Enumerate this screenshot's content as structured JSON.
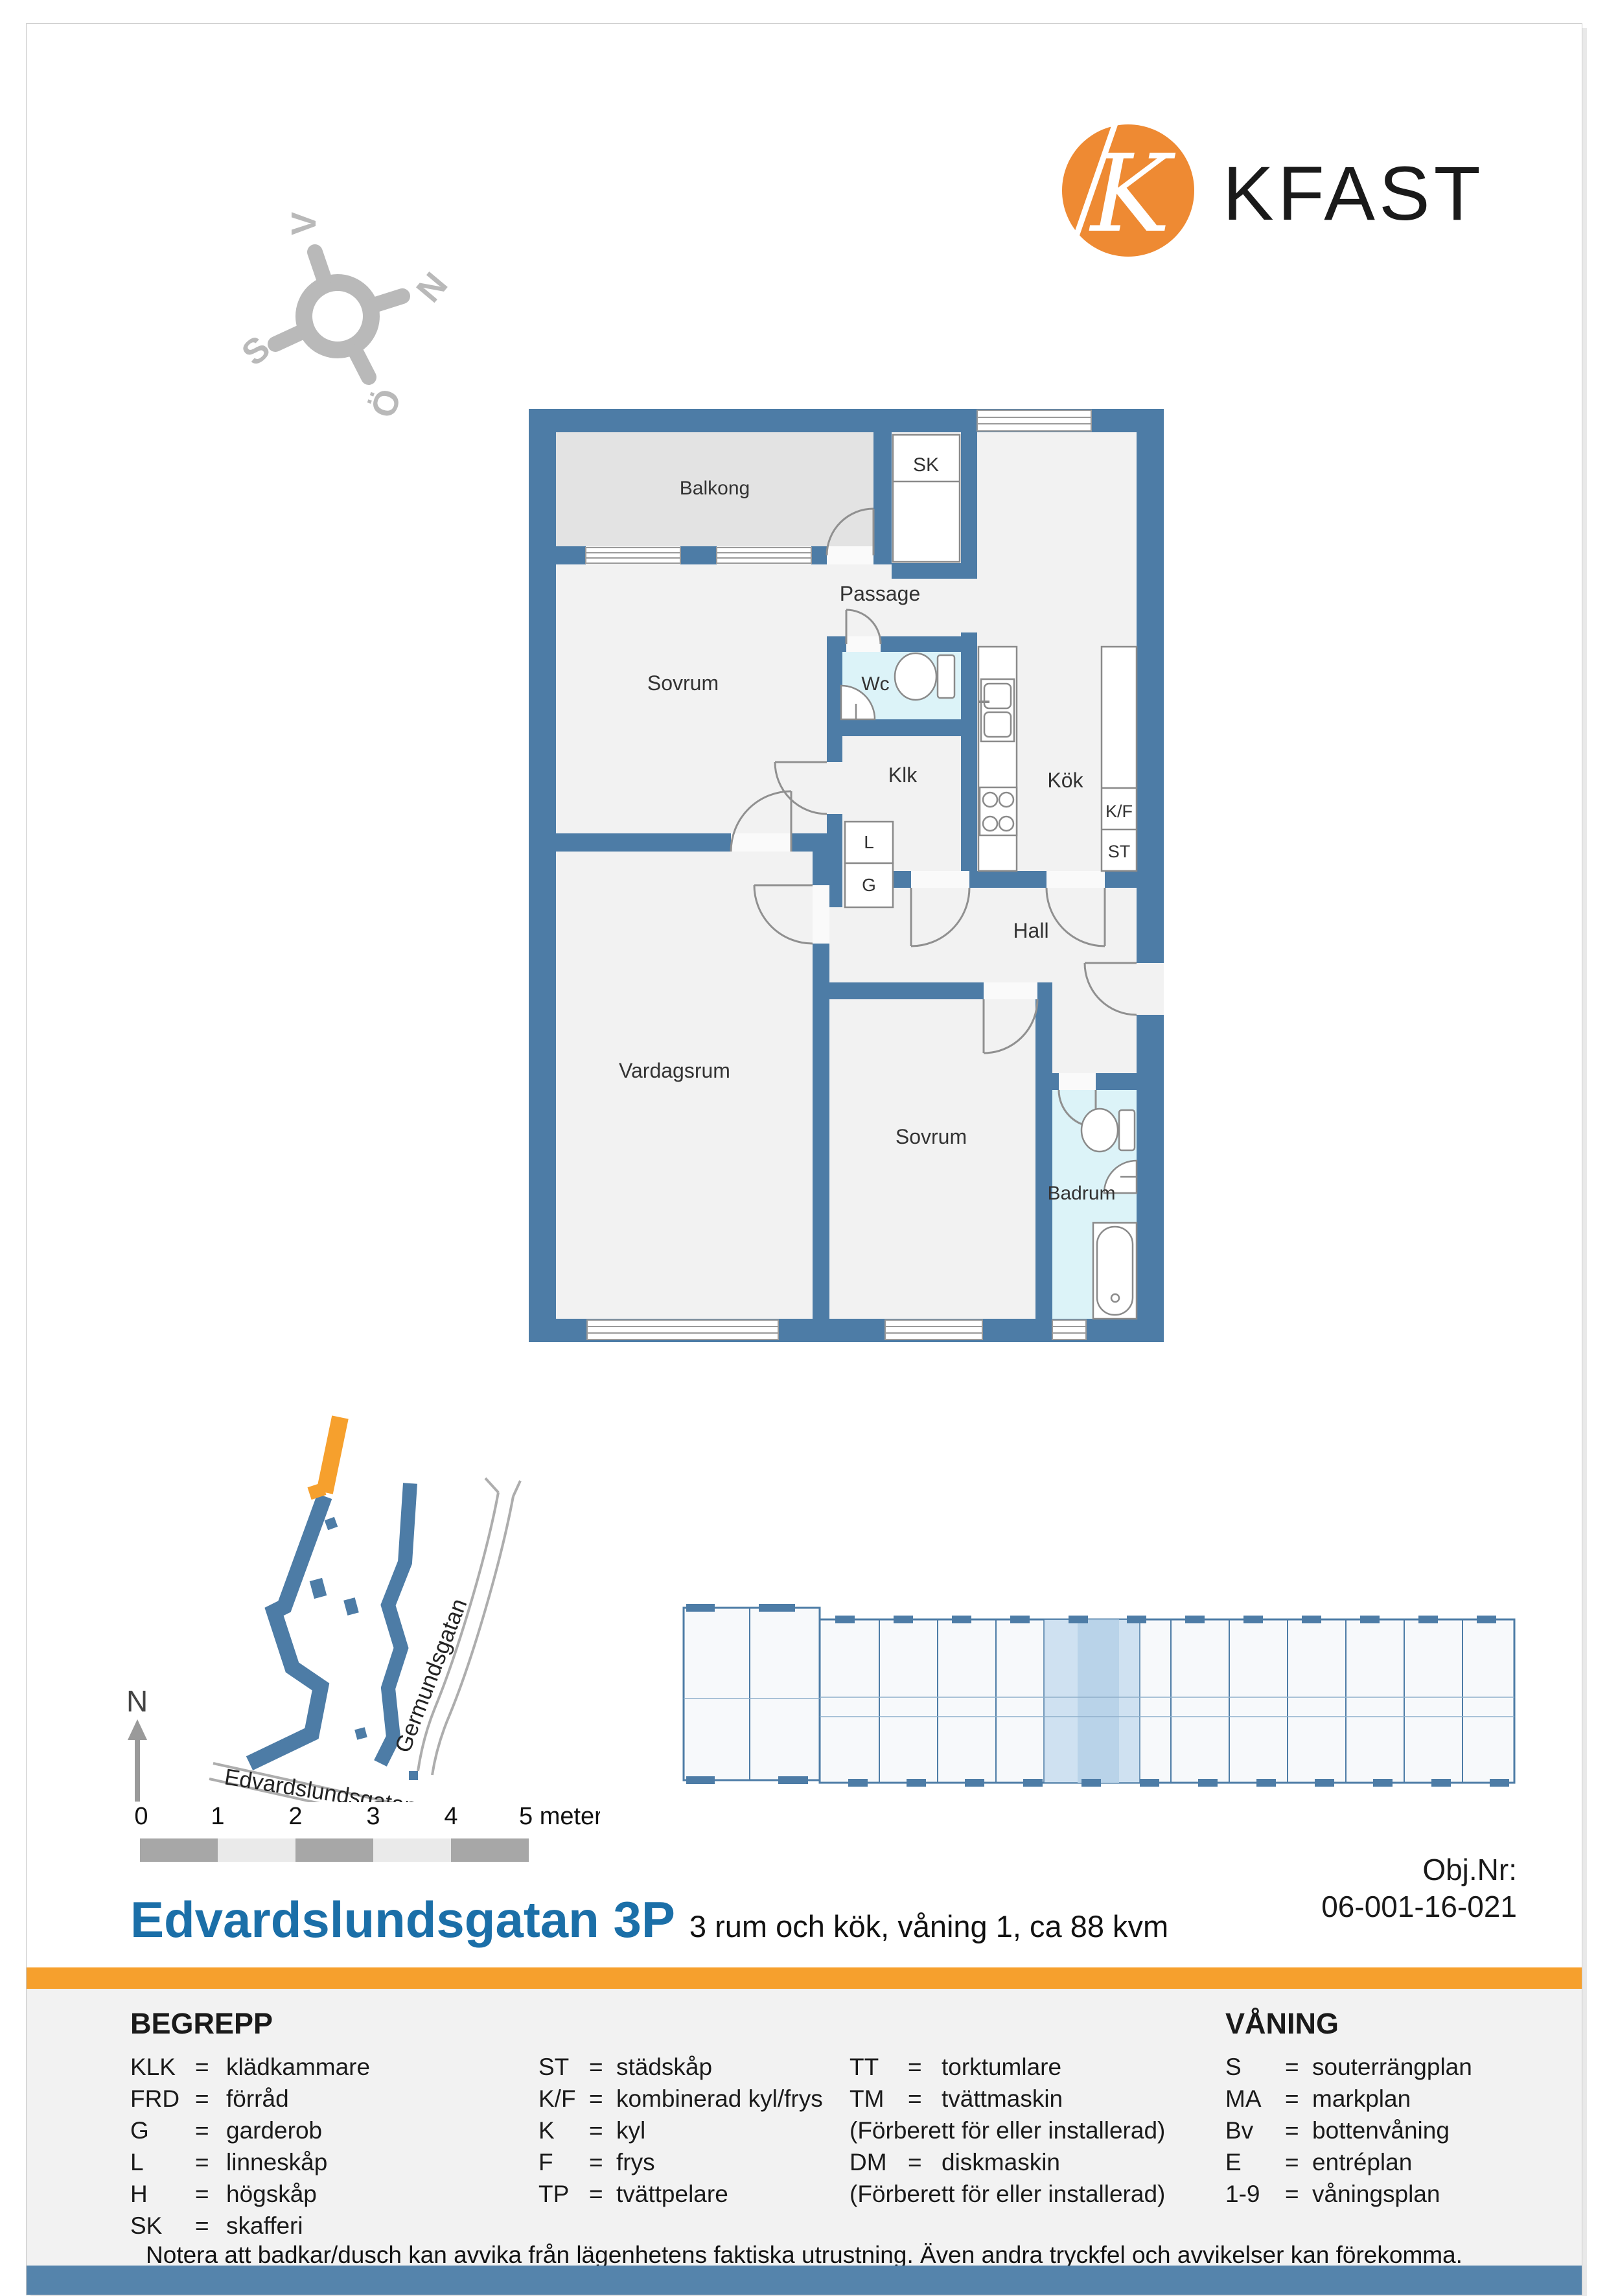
{
  "logo": {
    "k": "K",
    "name": "KFAST",
    "circle_color": "#EE8A33"
  },
  "compass": {
    "n": "N",
    "s": "S",
    "o": "Ö",
    "v": "V"
  },
  "floorplan": {
    "colors": {
      "wall": "#4D7CA6",
      "floor": "#F2F2F2",
      "balcony": "#E3E3E3",
      "wet": "#DCF3F8"
    },
    "rooms": {
      "balkong": "Balkong",
      "passage": "Passage",
      "sk": "SK",
      "sovrum1": "Sovrum",
      "wc": "Wc",
      "klk": "Klk",
      "kok": "Kök",
      "kf": "K/F",
      "st": "ST",
      "l": "L",
      "g": "G",
      "hall": "Hall",
      "vardagsrum": "Vardagsrum",
      "sovrum2": "Sovrum",
      "badrum": "Badrum"
    }
  },
  "sitemap": {
    "street1": "Germundsgatan",
    "street2": "Edvardslundsgatan",
    "north": "N",
    "highlight_color": "#F6A02D",
    "building_color": "#4D7CA6"
  },
  "overview": {
    "highlight_color": "#C9DCEE"
  },
  "scalebar": {
    "ticks": [
      "0",
      "1",
      "2",
      "3",
      "4"
    ],
    "last": "5 meter"
  },
  "title_block": {
    "title": "Edvardslundsgatan 3P",
    "subtitle": "3 rum och kök, våning 1, ca 88 kvm",
    "obj_label": "Obj.Nr:",
    "obj_number": "06-001-16-021"
  },
  "legend": {
    "heading": "BEGREPP",
    "eq": "=",
    "col1": [
      {
        "abbr": "KLK",
        "label": "klädkammare"
      },
      {
        "abbr": "FRD",
        "label": "förråd"
      },
      {
        "abbr": "G",
        "label": "garderob"
      },
      {
        "abbr": "L",
        "label": "linneskåp"
      },
      {
        "abbr": "H",
        "label": "högskåp"
      },
      {
        "abbr": "SK",
        "label": "skafferi"
      }
    ],
    "col2": [
      {
        "abbr": "ST",
        "label": "städskåp"
      },
      {
        "abbr": "K/F",
        "label": "kombinerad kyl/frys"
      },
      {
        "abbr": "K",
        "label": "kyl"
      },
      {
        "abbr": "F",
        "label": "frys"
      },
      {
        "abbr": "TP",
        "label": "tvättpelare"
      }
    ],
    "col3": [
      {
        "abbr": "TT",
        "label": "torktumlare"
      },
      {
        "abbr": "TM",
        "label": "tvättmaskin"
      },
      {
        "note": "(Förberett för eller installerad)"
      },
      {
        "abbr": "DM",
        "label": "diskmaskin"
      },
      {
        "note": "(Förberett för eller installerad)"
      }
    ],
    "vaning": {
      "heading": "VÅNING",
      "rows": [
        {
          "abbr": "S",
          "label": "souterrängplan"
        },
        {
          "abbr": "MA",
          "label": "markplan"
        },
        {
          "abbr": "Bv",
          "label": "bottenvåning"
        },
        {
          "abbr": "E",
          "label": "entréplan"
        },
        {
          "abbr": "1-9",
          "label": "våningsplan"
        }
      ]
    }
  },
  "footer": {
    "note": "Notera att badkar/dusch kan avvika från lägenhetens faktiska utrustning. Även andra tryckfel och avvikelser kan förekomma."
  }
}
